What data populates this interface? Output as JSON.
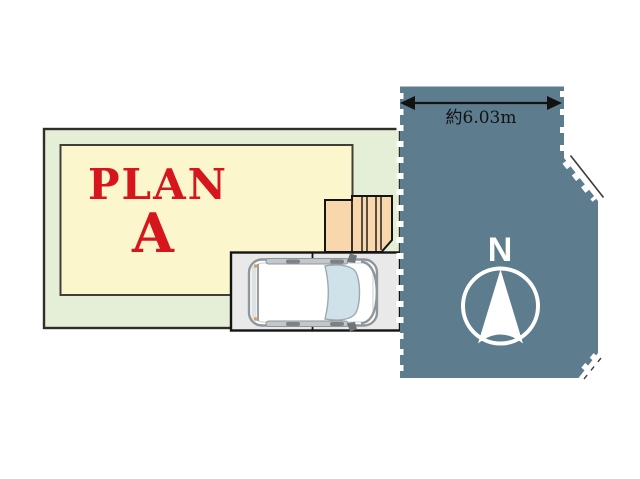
{
  "plan": {
    "line1": "PLAN",
    "line2": "A"
  },
  "dimension": {
    "label": "約6.03m"
  },
  "compass": {
    "label": "N"
  },
  "colors": {
    "site_fill": "#e5eed7",
    "site_border": "#2f2f2a",
    "building_fill": "#fcf6cd",
    "building_border": "#40403a",
    "stairs_fill": "#f7d7ab",
    "outline_dark": "#141414",
    "parking_fill": "#e9e9e9",
    "road_fill": "#5d7c8e",
    "plan_text": "#d6151d",
    "dimension_text": "#121212",
    "compass_color": "#ffffff",
    "car_body": "#ffffff",
    "car_outline": "#8f969b",
    "windshield": "#cfe2ea"
  }
}
